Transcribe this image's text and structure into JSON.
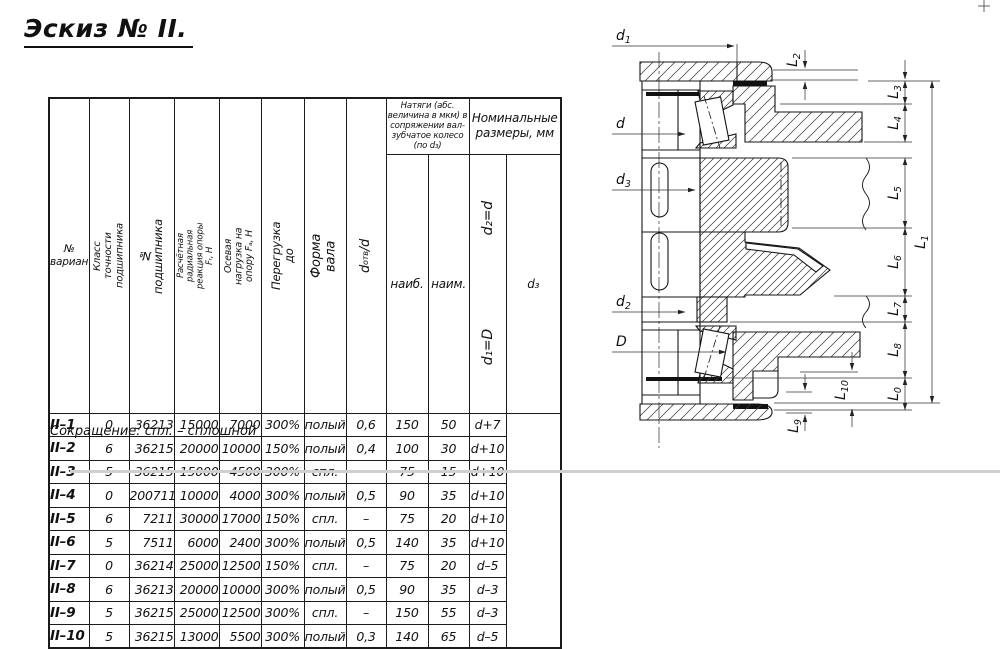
{
  "title": "Эскиз № II.",
  "note": "Сокращение: спл. – сплошной",
  "table": {
    "headers": {
      "variant": "№ варианта",
      "cls": "Класс точности подшипника",
      "bearing": "№ подшипника",
      "fr": "Расчётная радиальная реакция опоры Fᵣ, Н",
      "fa": "Осевая нагрузка на опору Fₐ, Н",
      "over": "Перегрузка до",
      "form": "Форма вала",
      "ratio": {
        "pre": "d",
        "sub": "отв",
        "post": "/d"
      },
      "natyagi": "Натяги (абс. величина в мкм) в сопряжении вал-зубчатое колесо (по d₃)",
      "naib": "наиб.",
      "naim": "наим.",
      "nominal": "Номинальные размеры, мм",
      "d3": "d₃",
      "group_top": "d₂=d",
      "group_bottom": "d₁=D"
    },
    "rows": [
      {
        "variant": "II–1",
        "cls": "0",
        "bearing": "36213",
        "fr": "15000",
        "fa": "7000",
        "over": "300%",
        "form": "полый",
        "ratio": "0,6",
        "naib": "150",
        "naim": "50",
        "d3": "d+7"
      },
      {
        "variant": "II–2",
        "cls": "6",
        "bearing": "36215",
        "fr": "20000",
        "fa": "10000",
        "over": "150%",
        "form": "полый",
        "ratio": "0,4",
        "naib": "100",
        "naim": "30",
        "d3": "d+10"
      },
      {
        "variant": "II–3",
        "cls": "5",
        "bearing": "36215",
        "fr": "15000",
        "fa": "4500",
        "over": "300%",
        "form": "спл.",
        "ratio": "–",
        "naib": "75",
        "naim": "15",
        "d3": "d+10"
      },
      {
        "variant": "II–4",
        "cls": "0",
        "bearing": "2007111",
        "fr": "10000",
        "fa": "4000",
        "over": "300%",
        "form": "полый",
        "ratio": "0,5",
        "naib": "90",
        "naim": "35",
        "d3": "d+10"
      },
      {
        "variant": "II–5",
        "cls": "6",
        "bearing": "7211",
        "fr": "30000",
        "fa": "17000",
        "over": "150%",
        "form": "спл.",
        "ratio": "–",
        "naib": "75",
        "naim": "20",
        "d3": "d+10"
      },
      {
        "variant": "II–6",
        "cls": "5",
        "bearing": "7511",
        "fr": "6000",
        "fa": "2400",
        "over": "300%",
        "form": "полый",
        "ratio": "0,5",
        "naib": "140",
        "naim": "35",
        "d3": "d+10"
      },
      {
        "variant": "II–7",
        "cls": "0",
        "bearing": "36214",
        "fr": "25000",
        "fa": "12500",
        "over": "150%",
        "form": "спл.",
        "ratio": "–",
        "naib": "75",
        "naim": "20",
        "d3": "d–5"
      },
      {
        "variant": "II–8",
        "cls": "6",
        "bearing": "36213",
        "fr": "20000",
        "fa": "10000",
        "over": "300%",
        "form": "полый",
        "ratio": "0,5",
        "naib": "90",
        "naim": "35",
        "d3": "d–3"
      },
      {
        "variant": "II–9",
        "cls": "5",
        "bearing": "36215",
        "fr": "25000",
        "fa": "12500",
        "over": "300%",
        "form": "спл.",
        "ratio": "–",
        "naib": "150",
        "naim": "55",
        "d3": "d–3"
      },
      {
        "variant": "II–10",
        "cls": "5",
        "bearing": "36215",
        "fr": "13000",
        "fa": "5500",
        "over": "300%",
        "form": "полый",
        "ratio": "0,3",
        "naib": "140",
        "naim": "65",
        "d3": "d–5"
      }
    ]
  },
  "drawing": {
    "d_labels": {
      "d1": {
        "base": "d",
        "sub": "1"
      },
      "d": {
        "base": "d",
        "sub": ""
      },
      "d3": {
        "base": "d",
        "sub": "3"
      },
      "d2": {
        "base": "d",
        "sub": "2"
      },
      "D": {
        "base": "D",
        "sub": ""
      }
    },
    "l_labels": {
      "L2": {
        "base": "L",
        "sub": "2"
      },
      "L3": {
        "base": "L",
        "sub": "3"
      },
      "L4": {
        "base": "L",
        "sub": "4"
      },
      "L5": {
        "base": "L",
        "sub": "5"
      },
      "L6": {
        "base": "L",
        "sub": "6"
      },
      "L7": {
        "base": "L",
        "sub": "7"
      },
      "L8": {
        "base": "L",
        "sub": "8"
      },
      "L0": {
        "base": "L",
        "sub": "0"
      },
      "L1": {
        "base": "L",
        "sub": "1"
      },
      "L10": {
        "base": "L",
        "sub": "10"
      },
      "L9": {
        "base": "L",
        "sub": "9"
      }
    }
  }
}
